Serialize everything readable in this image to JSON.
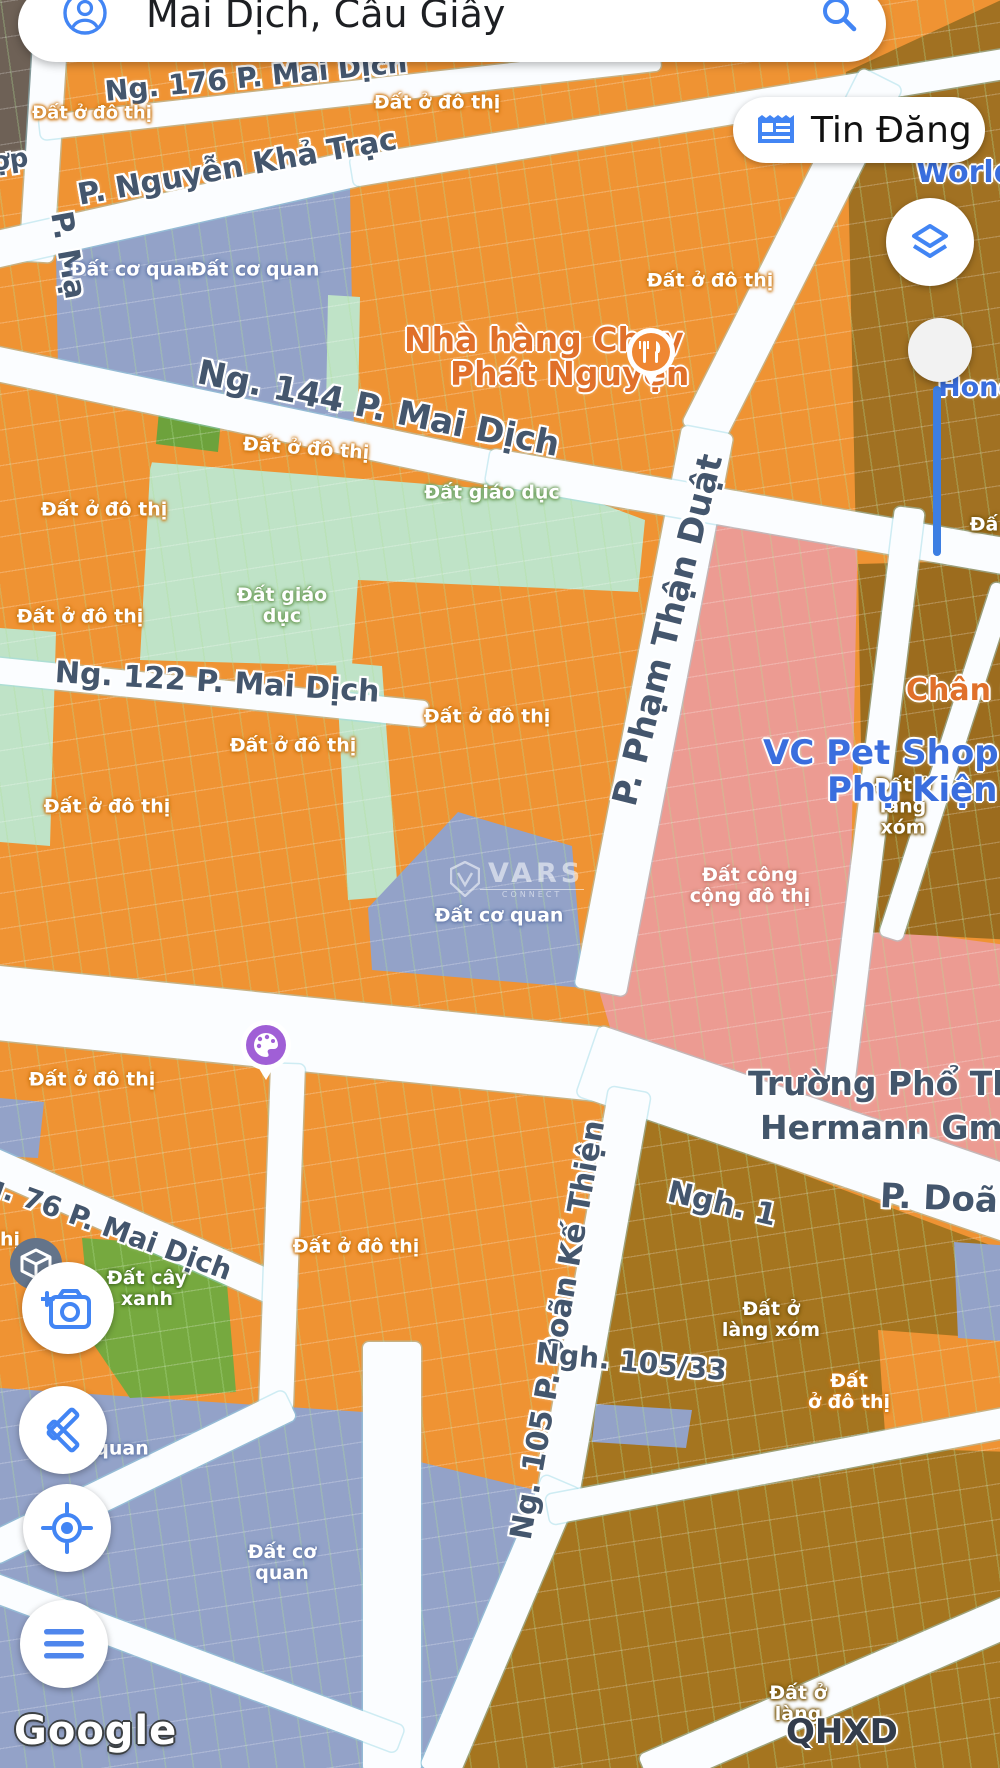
{
  "search": {
    "query": "Mai Dịch, Cầu Giấy"
  },
  "toolbar": {
    "tin_dang_label": "Tin Đăng"
  },
  "icons": {
    "account": "person-circle",
    "search": "magnifier",
    "tin_dang": "newspaper",
    "layers": "map-layers",
    "camera": "camera-plus",
    "tools": "crossed-pencil-ruler",
    "locate": "gps-crosshair",
    "menu": "hamburger",
    "restaurant": "fork-knife",
    "palette": "paint-palette",
    "ar": "cube"
  },
  "colors": {
    "accent_blue": "#4285f4",
    "urban_orange": "#ef9333",
    "office_periwinkle": "#93a2c8",
    "education_green": "#bfe3c7",
    "park_green": "#76a93f",
    "public_pink": "#ec9b92",
    "village_brown": "#a5751f",
    "route_blue": "#3c7ee2"
  },
  "streets": {
    "ng176": "Ng. 176 P. Mai Dịch",
    "nguyen_kha_trac": "P. Nguyễn Khả Trạc",
    "ng144": "Ng. 144 P. Mai Dịch",
    "ng122": "Ng. 122 P. Mai Dịch",
    "pham_than_duat": "P. Phạm Thận Duật",
    "ng76": "Ng. 76 P. Mai Dịch",
    "doan_ke_thien": "Ng. 105 P. Doãn Kế Thiện",
    "ngh1": "Ngh. 1",
    "p_doan": "P. Doãn",
    "ngh105_33": "Ngh. 105/33",
    "p_ma_partial": "P. Mạ",
    "op_partial": "ợp"
  },
  "labels": {
    "a1": "Đất ở đô thị",
    "a2": "Đất ở đô thị",
    "a3": "Đất ở đô thị",
    "a4": "Đất ở đô thị",
    "a5": "Đất ở đô thị",
    "a6": "Đất ở đô thị",
    "a7": "Đất giáo dục",
    "a8": "Đất giáo\ndục",
    "a9": "Đất ở đô thị",
    "a10": "Đất ở đô thị",
    "a11": "Đất ở đô thị",
    "a12": "Đất cơ quan",
    "a13": "Đất cơ quan",
    "a14": "Đất cơ quan",
    "a15": "Đất công\ncộng đô thị",
    "a16": "Đất ở\nlàng\nxóm",
    "a17": "Đất ở đô thị",
    "a18": "Đất ở đô thị",
    "a19": "Đất cây\nxanh",
    "a20": "Đất ở\nlàng xóm",
    "a21": "Đất\nở đô thị",
    "a22": "Đất cơ\nquan",
    "a23": "quan",
    "a24": "Đất ở\nlàng",
    "a25": "hị",
    "a26": "Đấ"
  },
  "pois": {
    "restaurant_line1": "Nhà hàng Chay",
    "restaurant_line2": "Phát Nguyện",
    "pet_shop_line1": "VC Pet Shop - Th",
    "pet_shop_line2": "Phụ Kiện Thu",
    "school_line1": "Trường Phổ Th",
    "school_line2": "Hermann Gme",
    "world_partial": "World",
    "hond_partial": "Hond",
    "chan_partial": "Chân Ch"
  },
  "watermarks": {
    "google": "Google",
    "qhxd": "QHXD",
    "vars": "VARS",
    "vars_sub": "CONNECT"
  }
}
